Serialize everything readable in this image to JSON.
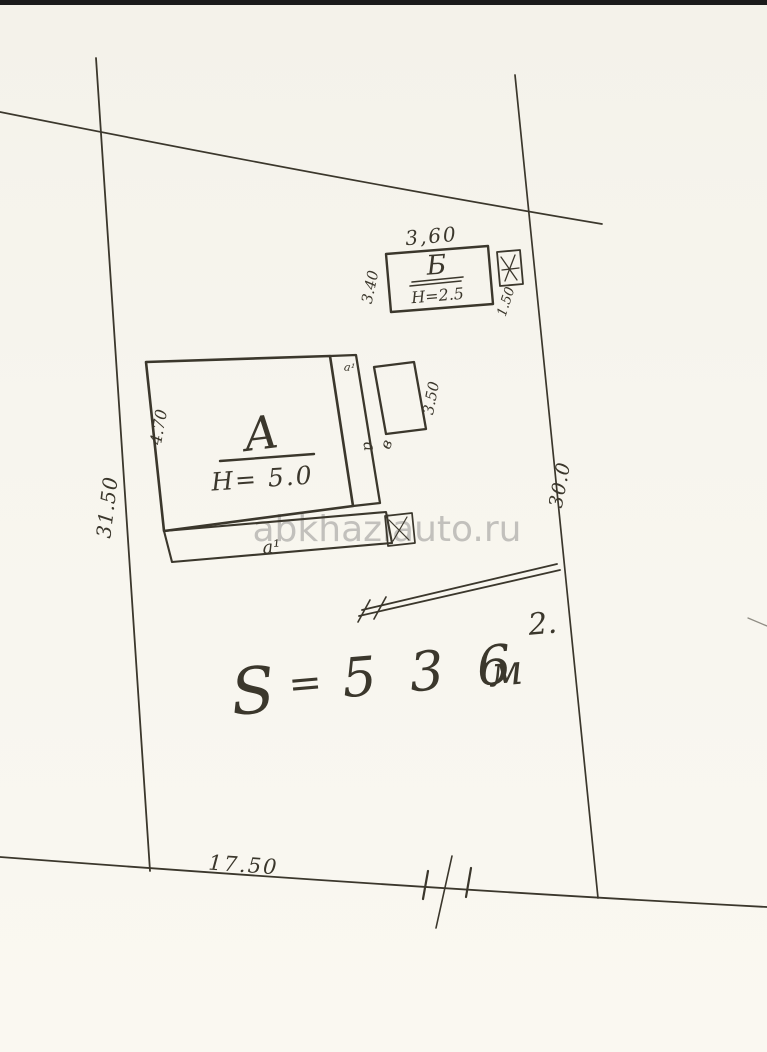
{
  "watermark": {
    "text": "abkhaziauto.ru"
  },
  "plot": {
    "dim_left": "31.50",
    "dim_right": "30.0",
    "dim_bottom": "17.50"
  },
  "area": {
    "s": "S",
    "eq": "=",
    "value": "5 3 6",
    "unit": "м",
    "sup": "2."
  },
  "building_a": {
    "name": "А",
    "height": "Н= 5.0",
    "dim_left": "4.70",
    "annex_dim": "3.50",
    "annex_label": "в",
    "strip_label": "а",
    "strip_top_label": "а¹",
    "porch_label": "а¹"
  },
  "building_b": {
    "name": "Б",
    "height": "Н=2.5",
    "dim_top": "3,60",
    "dim_left": "3.40",
    "dim_step": "1.50"
  },
  "colors": {
    "ink": "#3b372c",
    "paper": "#f6f4ed",
    "watermark": "#a2a19e"
  }
}
